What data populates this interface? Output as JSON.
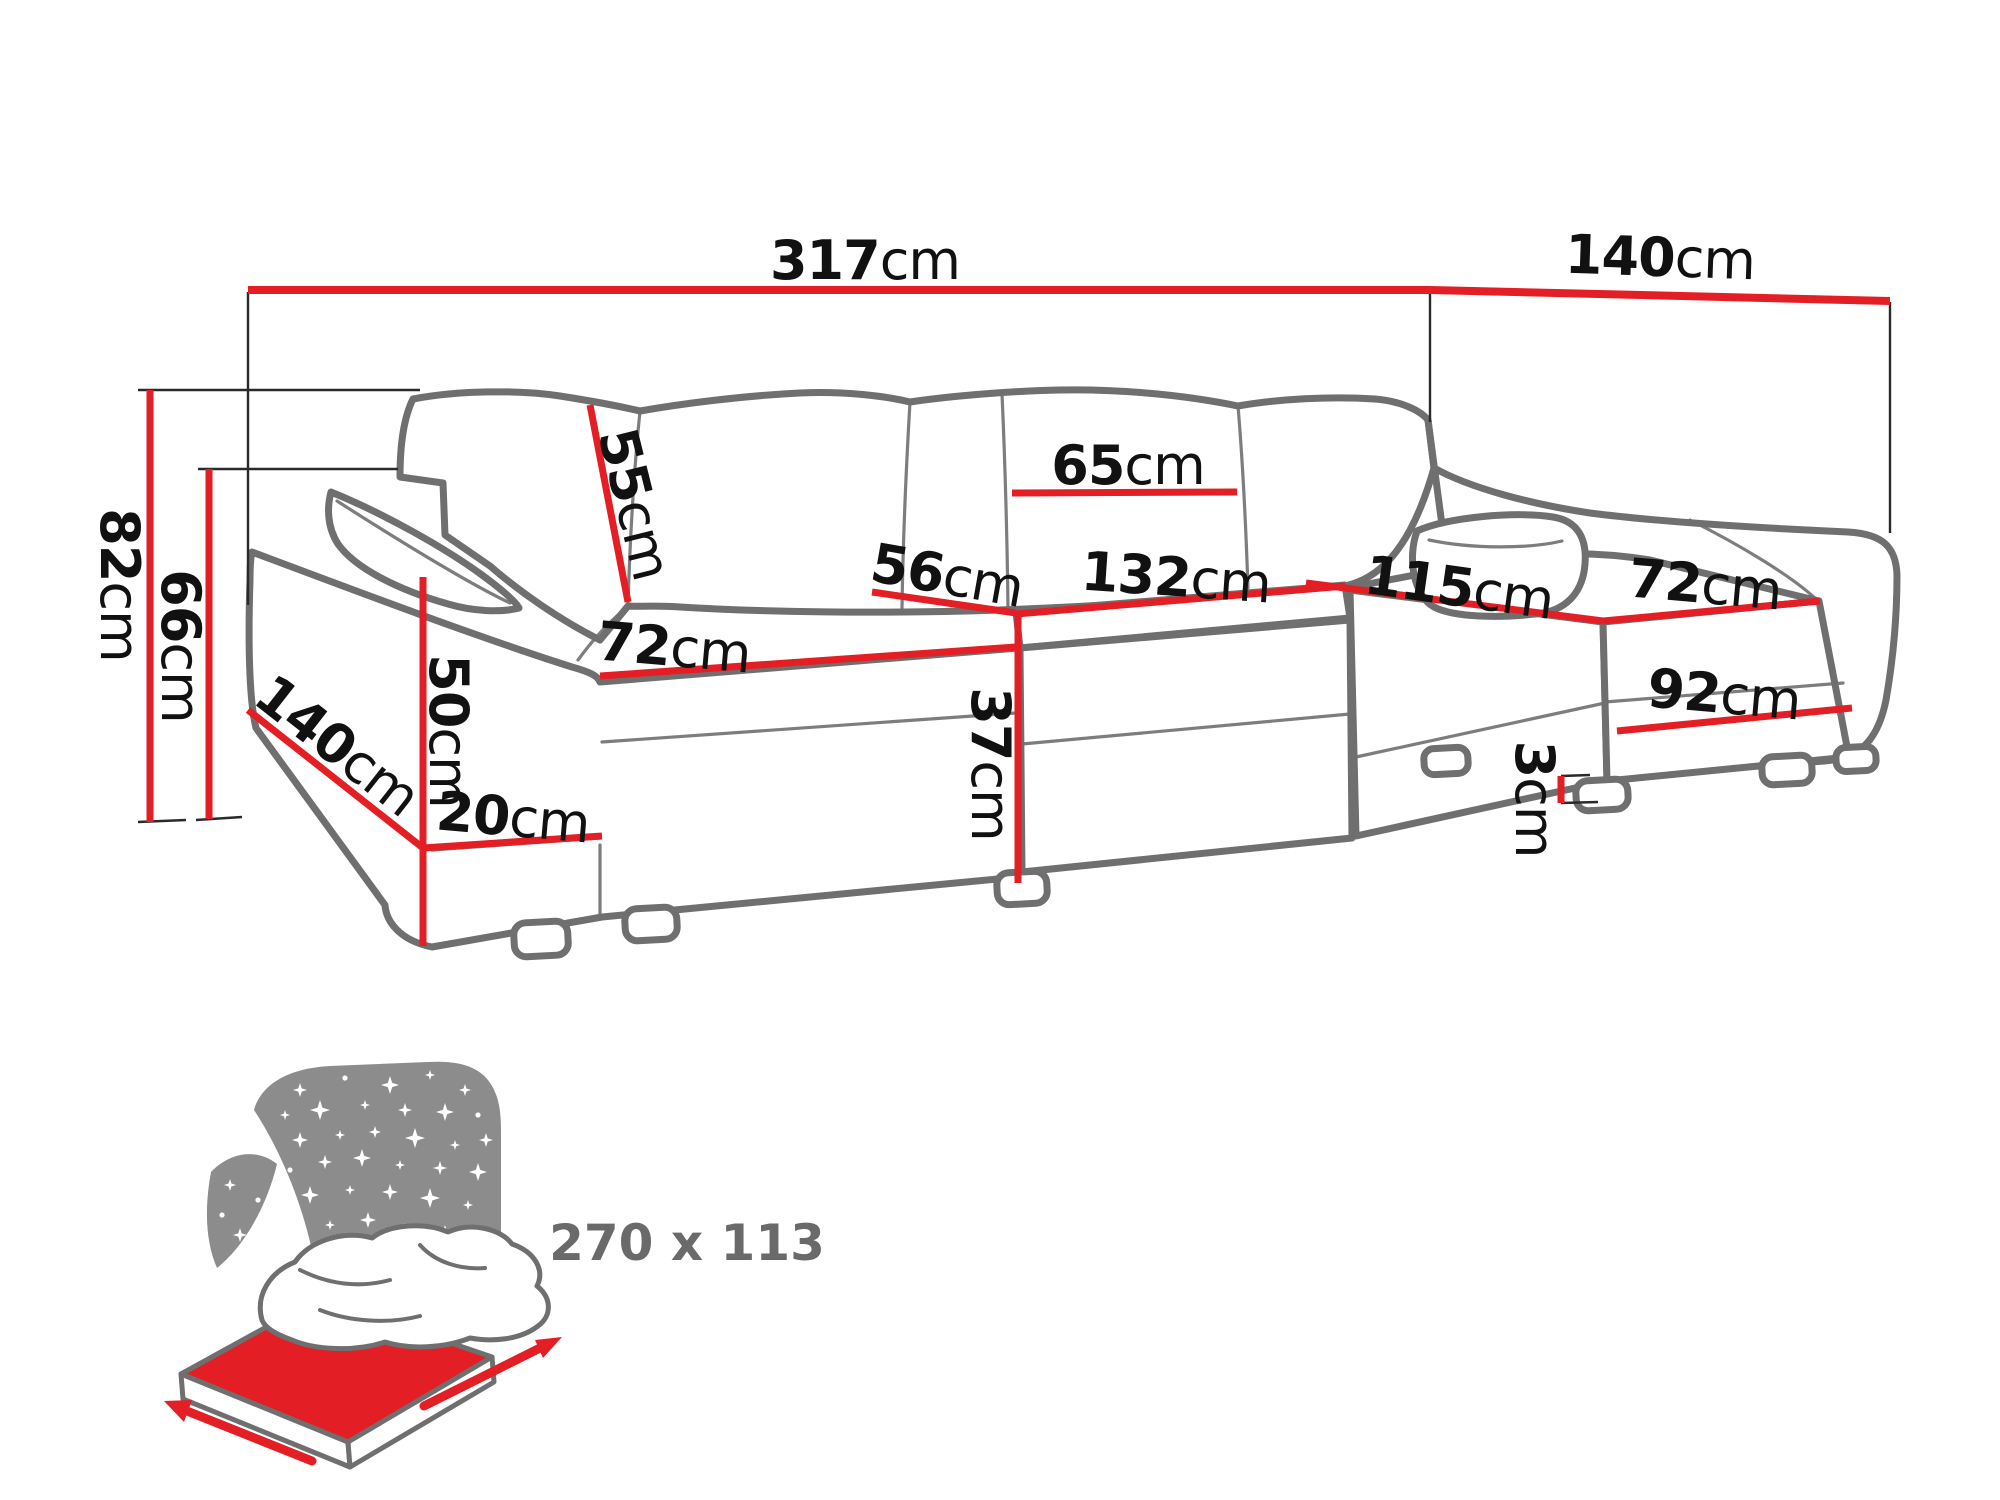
{
  "meta": {
    "description": "Dimension diagram of a U-shaped corner sofa bed",
    "unit": "cm"
  },
  "colors": {
    "accent_red": "#e31e24",
    "outline_gray": "#6f6f6f",
    "label_color": "#111111",
    "icon_gray": "#8c8c8c",
    "icon_text_color": "#6a6a6a",
    "background": "#ffffff"
  },
  "dimensions": [
    {
      "id": "total-width",
      "value": "317",
      "unit": "cm",
      "x": 865,
      "y": 261,
      "rot": 0
    },
    {
      "id": "right-section-depth",
      "value": "140",
      "unit": "cm",
      "x": 1660,
      "y": 258,
      "rot": 2
    },
    {
      "id": "back-height",
      "value": "82",
      "unit": "cm",
      "x": 119,
      "y": 585,
      "rot": 90
    },
    {
      "id": "arm-height",
      "value": "66",
      "unit": "cm",
      "x": 180,
      "y": 646,
      "rot": 90
    },
    {
      "id": "back-cushion-height",
      "value": "55",
      "unit": "cm",
      "x": 634,
      "y": 504,
      "rot": 76
    },
    {
      "id": "back-cushion-width",
      "value": "65",
      "unit": "cm",
      "x": 1128,
      "y": 466,
      "rot": 0
    },
    {
      "id": "seat-depth",
      "value": "56",
      "unit": "cm",
      "x": 947,
      "y": 576,
      "rot": 10
    },
    {
      "id": "middle-seat-width",
      "value": "132",
      "unit": "cm",
      "x": 1176,
      "y": 578,
      "rot": 4
    },
    {
      "id": "right-seat-length",
      "value": "115",
      "unit": "cm",
      "x": 1459,
      "y": 588,
      "rot": 8
    },
    {
      "id": "right-seat-width",
      "value": "72",
      "unit": "cm",
      "x": 1705,
      "y": 585,
      "rot": 5
    },
    {
      "id": "left-seat-width",
      "value": "72",
      "unit": "cm",
      "x": 674,
      "y": 648,
      "rot": 5
    },
    {
      "id": "arm-height-from-seat",
      "value": "50",
      "unit": "cm",
      "x": 448,
      "y": 731,
      "rot": 90
    },
    {
      "id": "left-section-depth",
      "value": "140",
      "unit": "cm",
      "x": 337,
      "y": 746,
      "rot": 38
    },
    {
      "id": "base-height",
      "value": "20",
      "unit": "cm",
      "x": 513,
      "y": 818,
      "rot": 5
    },
    {
      "id": "seat-height",
      "value": "37",
      "unit": "cm",
      "x": 990,
      "y": 764,
      "rot": 90
    },
    {
      "id": "right-front-length",
      "value": "92",
      "unit": "cm",
      "x": 1724,
      "y": 695,
      "rot": 5
    },
    {
      "id": "leg-height",
      "value": "3",
      "unit": "cm",
      "x": 1534,
      "y": 799,
      "rot": 90
    }
  ],
  "bed_icon": {
    "sleeping_area": "270 x 113",
    "meaning": "fold-out sleeping surface"
  }
}
